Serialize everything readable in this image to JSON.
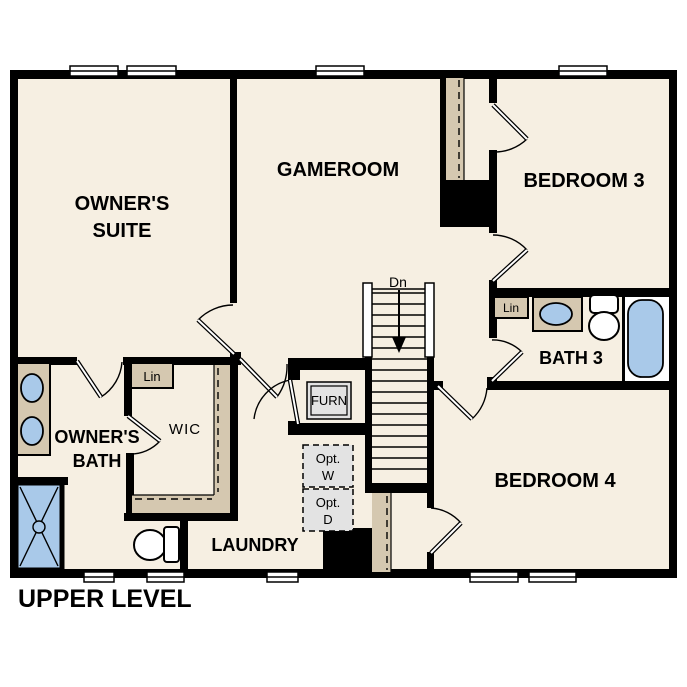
{
  "title": "UPPER LEVEL",
  "rooms": {
    "owners_suite": {
      "line1": "OWNER'S",
      "line2": "SUITE"
    },
    "gameroom": {
      "label": "GAMEROOM"
    },
    "bedroom3": {
      "label": "BEDROOM 3"
    },
    "bath3": {
      "label": "BATH 3"
    },
    "bedroom4": {
      "label": "BEDROOM 4"
    },
    "owners_bath": {
      "line1": "OWNER'S",
      "line2": "BATH"
    },
    "wic": {
      "label": "WIC"
    },
    "laundry": {
      "label": "LAUNDRY"
    }
  },
  "annotations": {
    "furnace": "FURN",
    "stairs_down": "Dn",
    "wic_linen": "Lin",
    "bath3_linen": "Lin",
    "opt_washer": {
      "line1": "Opt.",
      "line2": "W"
    },
    "opt_dryer": {
      "line1": "Opt.",
      "line2": "D"
    }
  },
  "colors": {
    "floor": "#f6efe2",
    "wall": "#000000",
    "shelf_tan": "#d5c8b0",
    "fixture_blue": "#a9c9e9",
    "appliance_gray": "#e3e3e3",
    "background": "#ffffff"
  }
}
